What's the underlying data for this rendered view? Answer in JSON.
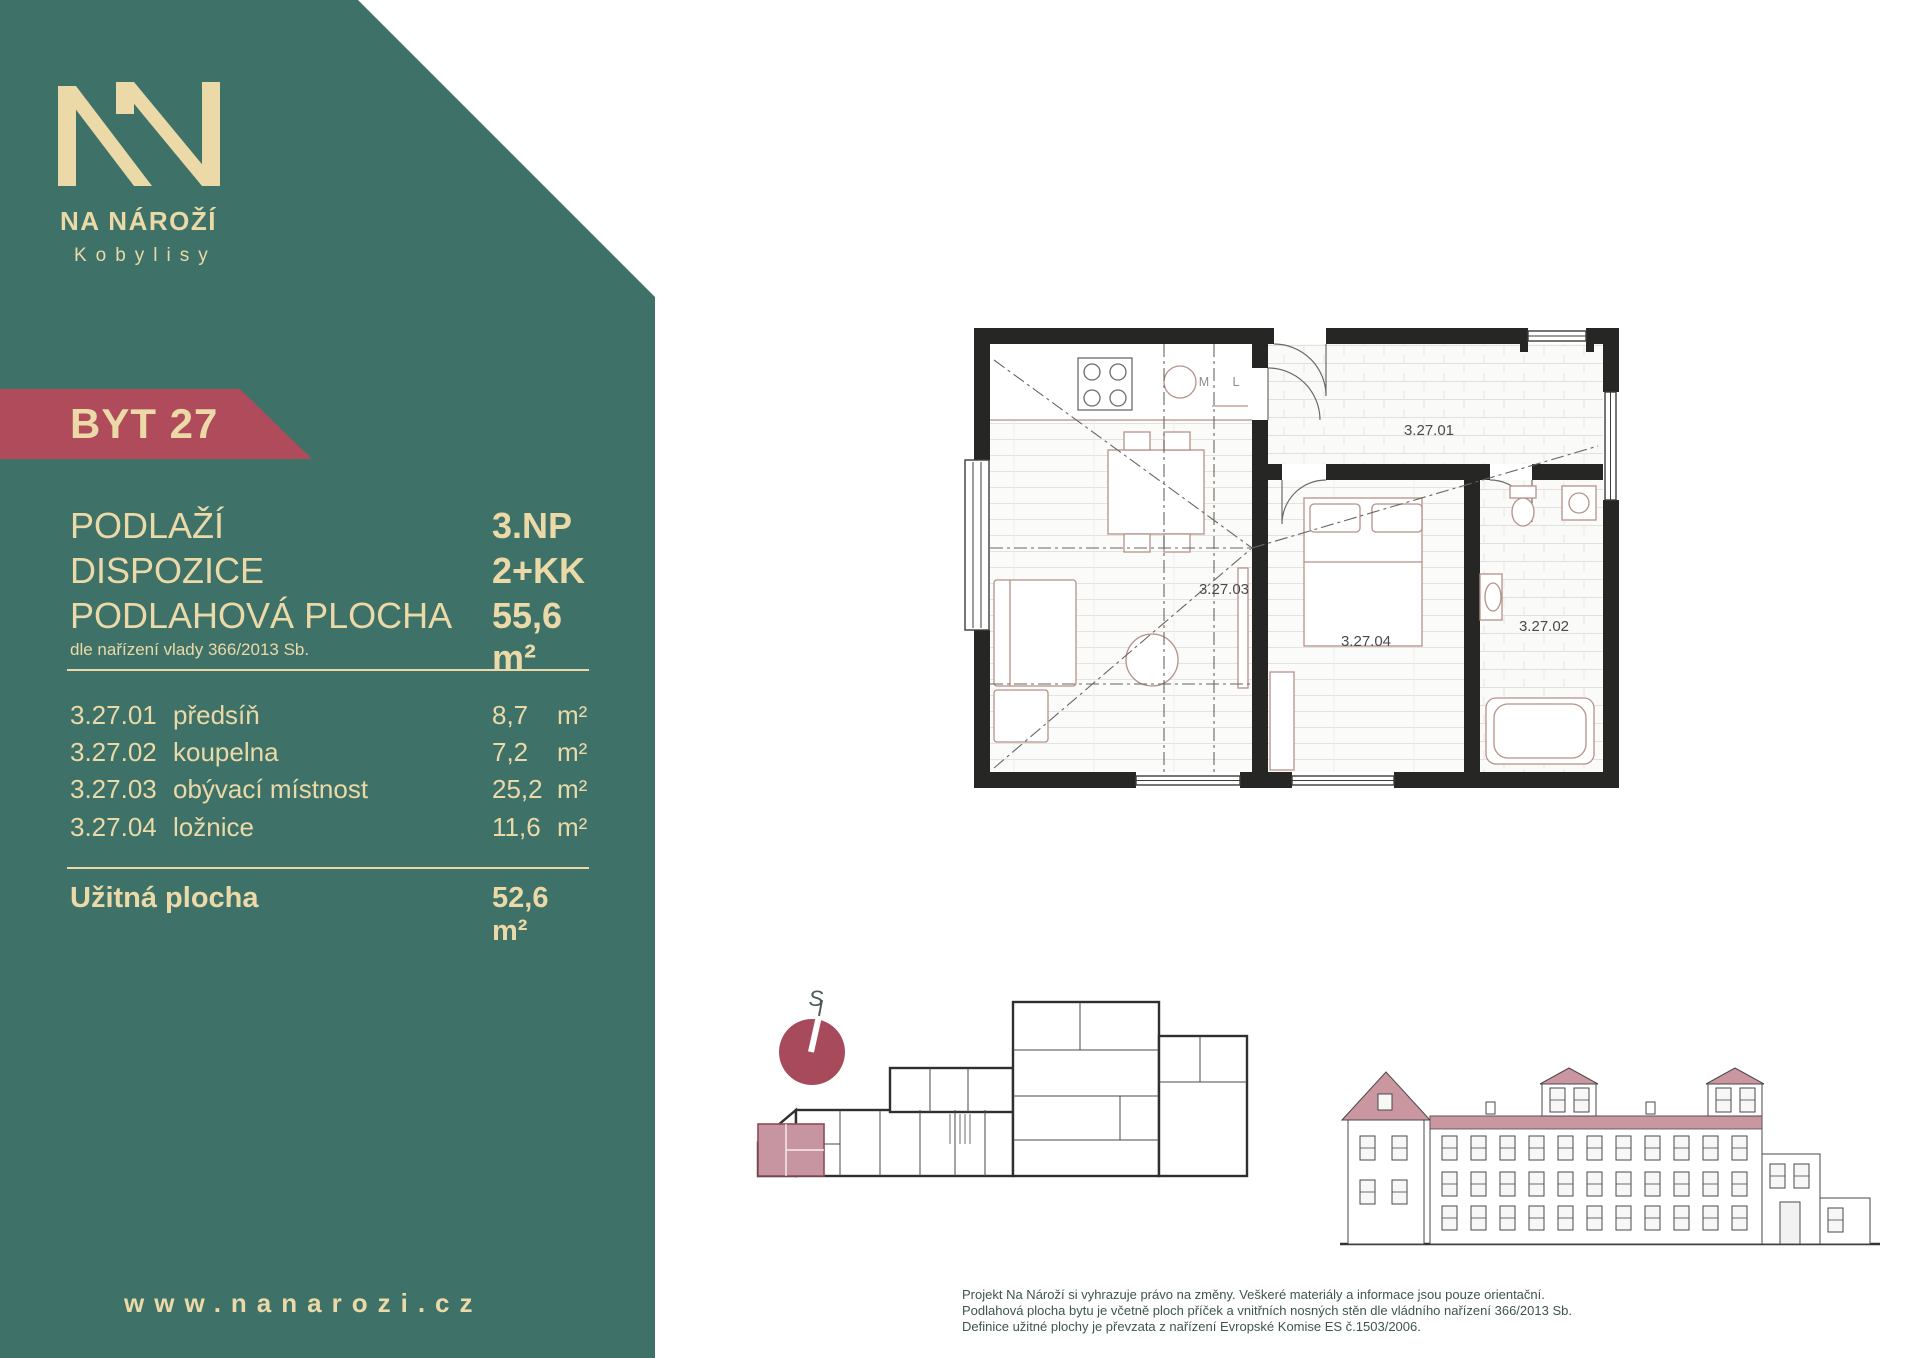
{
  "brand": {
    "name": "NA NÁROŽÍ",
    "subtitle": "Kobylisy"
  },
  "badge": {
    "label": "BYT 27"
  },
  "summary": {
    "rows": [
      {
        "label": "PODLAŽÍ",
        "value": "3.NP"
      },
      {
        "label": "DISPOZICE",
        "value": "2+KK"
      },
      {
        "label": "PODLAHOVÁ PLOCHA",
        "value": "55,6 m²"
      }
    ],
    "note": "dle nařízení vlady 366/2013 Sb."
  },
  "rooms": [
    {
      "code": "3.27.01",
      "name": "předsíň",
      "area": "8,7",
      "unit": "m²"
    },
    {
      "code": "3.27.02",
      "name": "koupelna",
      "area": "7,2",
      "unit": "m²"
    },
    {
      "code": "3.27.03",
      "name": "obývací místnost",
      "area": "25,2",
      "unit": "m²"
    },
    {
      "code": "3.27.04",
      "name": "ložnice",
      "area": "11,6",
      "unit": "m²"
    }
  ],
  "total": {
    "label": "Užitná plocha",
    "value": "52,6 m²"
  },
  "website": "www.nanarozi.cz",
  "floorplan": {
    "labels": {
      "hall": "3.27.01",
      "bathroom": "3.27.02",
      "living": "3.27.03",
      "bedroom": "3.27.04",
      "dishwasher": "M",
      "fridge": "L"
    }
  },
  "compass": {
    "label": "S"
  },
  "disclaimer": [
    "Projekt Na Nároží si vyhrazuje právo na změny. Veškeré materiály a informace jsou pouze orientační.",
    "Podlahová plocha bytu je včetně ploch příček a vnitřních nosných stěn dle vládního nařízení 366/2013 Sb.",
    "Definice užitné plochy je převzata z nařízení Evropské Komise ES č.1503/2006."
  ],
  "colors": {
    "teal": "#3E7268",
    "cream": "#EBD9A8",
    "maroon": "#B04B5C",
    "pink": "#C795A1"
  }
}
